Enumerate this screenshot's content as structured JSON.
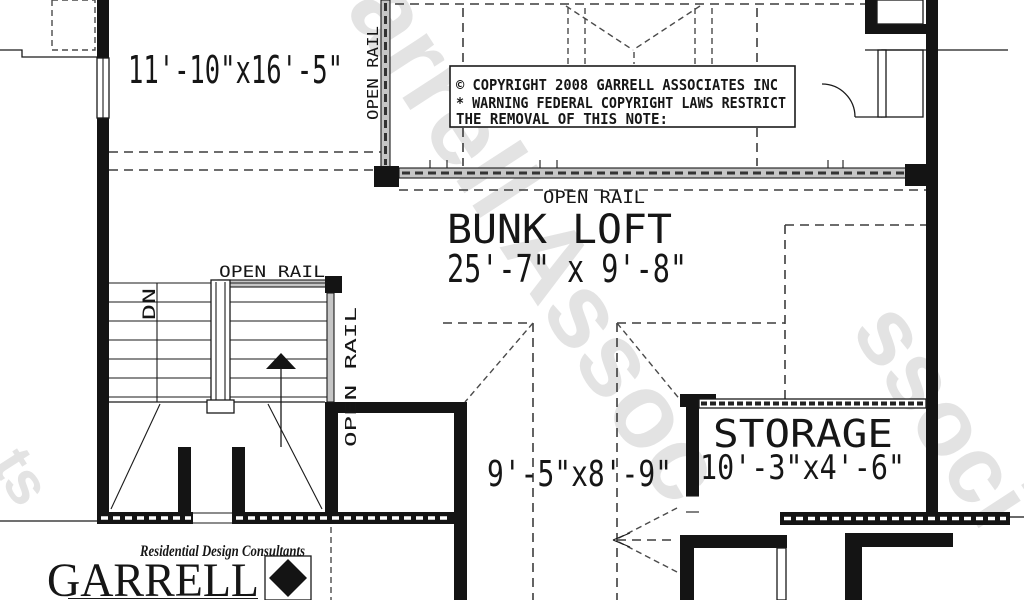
{
  "watermark": {
    "text": "Garrell Assoc",
    "fragment_right": "ssoci",
    "fragment_left": "ts"
  },
  "plan": {
    "left_room_dim": "11'-10\"x16'-5\"",
    "bunk_loft_name": "BUNK LOFT",
    "bunk_loft_dim": "25'-7\" x 9'-8\"",
    "center_dim": "9'-5\"x8'-9\"",
    "storage_name": "STORAGE",
    "storage_dim": "10'-3\"x4'-6\"",
    "open_rail": "OPEN RAIL",
    "down": "DN"
  },
  "copyright": {
    "line1": "© COPYRIGHT 2008 GARRELL ASSOCIATES INC",
    "line2": "* WARNING FEDERAL COPYRIGHT LAWS RESTRICT",
    "line3": "THE REMOVAL OF THIS NOTE:"
  },
  "logo": {
    "tagline": "Residential Design Consultants",
    "brand": "GARRELL"
  },
  "colors": {
    "line": "#1a1a1a",
    "rail_fill": "#c6c6c6",
    "watermark": "#e3e3e3"
  }
}
